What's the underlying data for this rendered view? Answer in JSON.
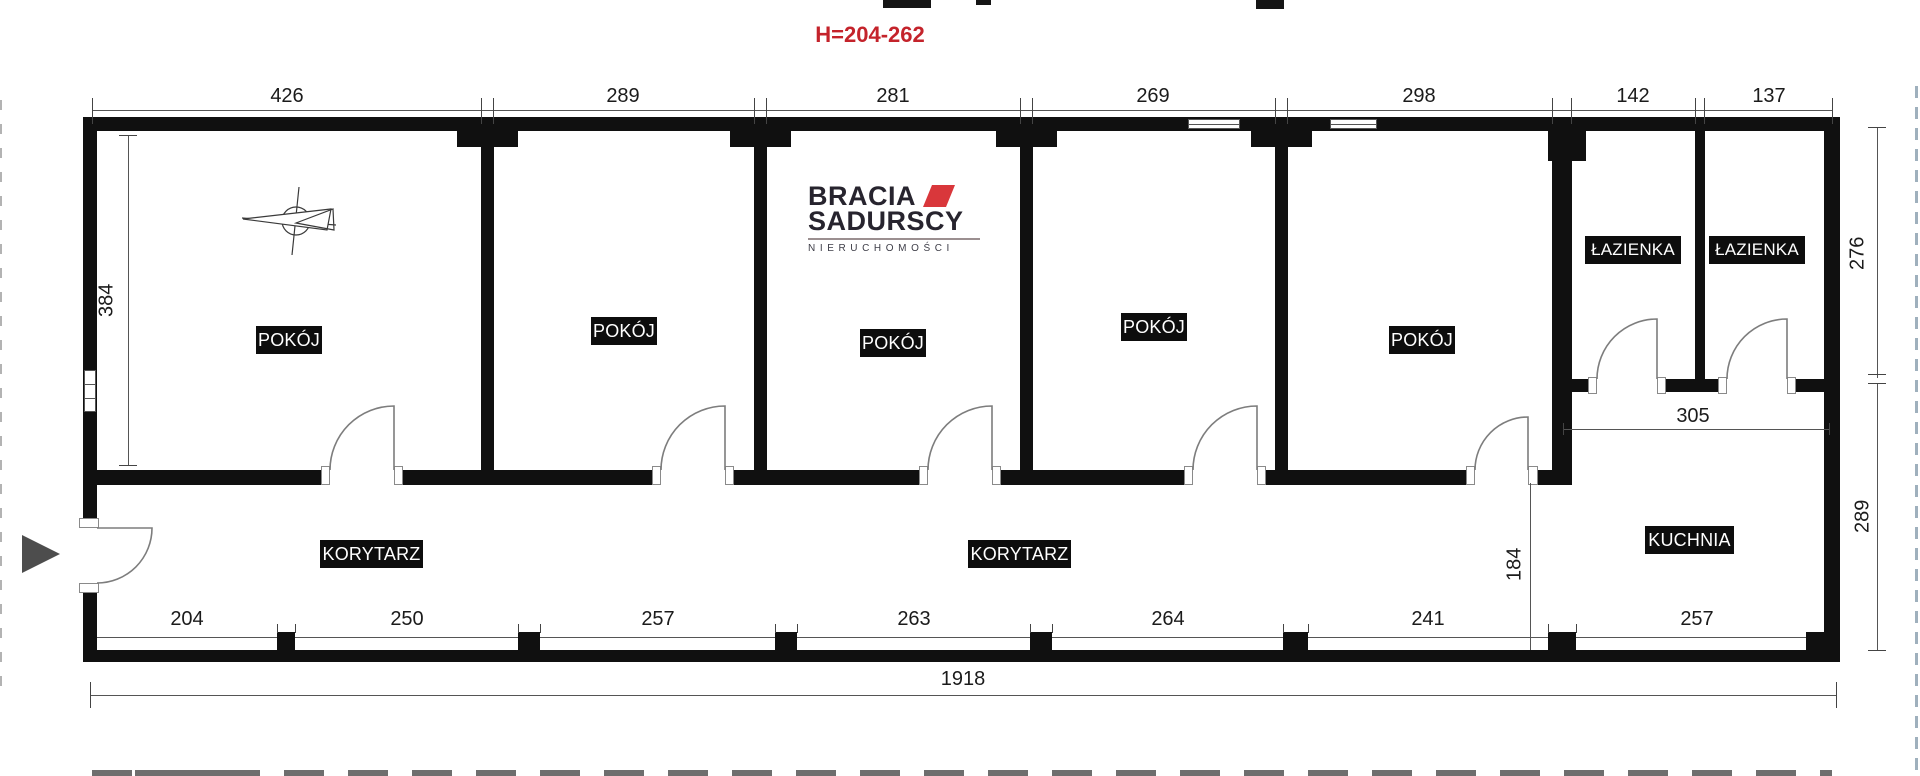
{
  "title": "H=204-262",
  "logo": {
    "brand_top": "BRACIA",
    "brand_bottom": "SADURSCY",
    "subtitle": "NIERUCHOMOŚCI",
    "accent_color": "#d9373b",
    "text_color": "#27242e"
  },
  "colors": {
    "wall": "#101010",
    "title_red": "#c4232b",
    "label_bg": "#0d0d0d",
    "label_fg": "#ffffff"
  },
  "rooms": [
    {
      "label": "POKÓJ"
    },
    {
      "label": "POKÓJ"
    },
    {
      "label": "POKÓJ"
    },
    {
      "label": "POKÓJ"
    },
    {
      "label": "POKÓJ"
    }
  ],
  "bathrooms": [
    {
      "label": "ŁAZIENKA"
    },
    {
      "label": "ŁAZIENKA"
    }
  ],
  "corridors": [
    {
      "label": "KORYTARZ"
    },
    {
      "label": "KORYTARZ"
    }
  ],
  "kitchen": {
    "label": "KUCHNIA"
  },
  "dims": {
    "top": [
      "426",
      "289",
      "281",
      "269",
      "298",
      "142",
      "137"
    ],
    "bottom": [
      "204",
      "250",
      "257",
      "263",
      "264",
      "241",
      "257"
    ],
    "left_room_height": "384",
    "right_upper": "276",
    "right_lower": "289",
    "kitchen_width": "305",
    "corridor_opening": "184",
    "total_width": "1918"
  }
}
